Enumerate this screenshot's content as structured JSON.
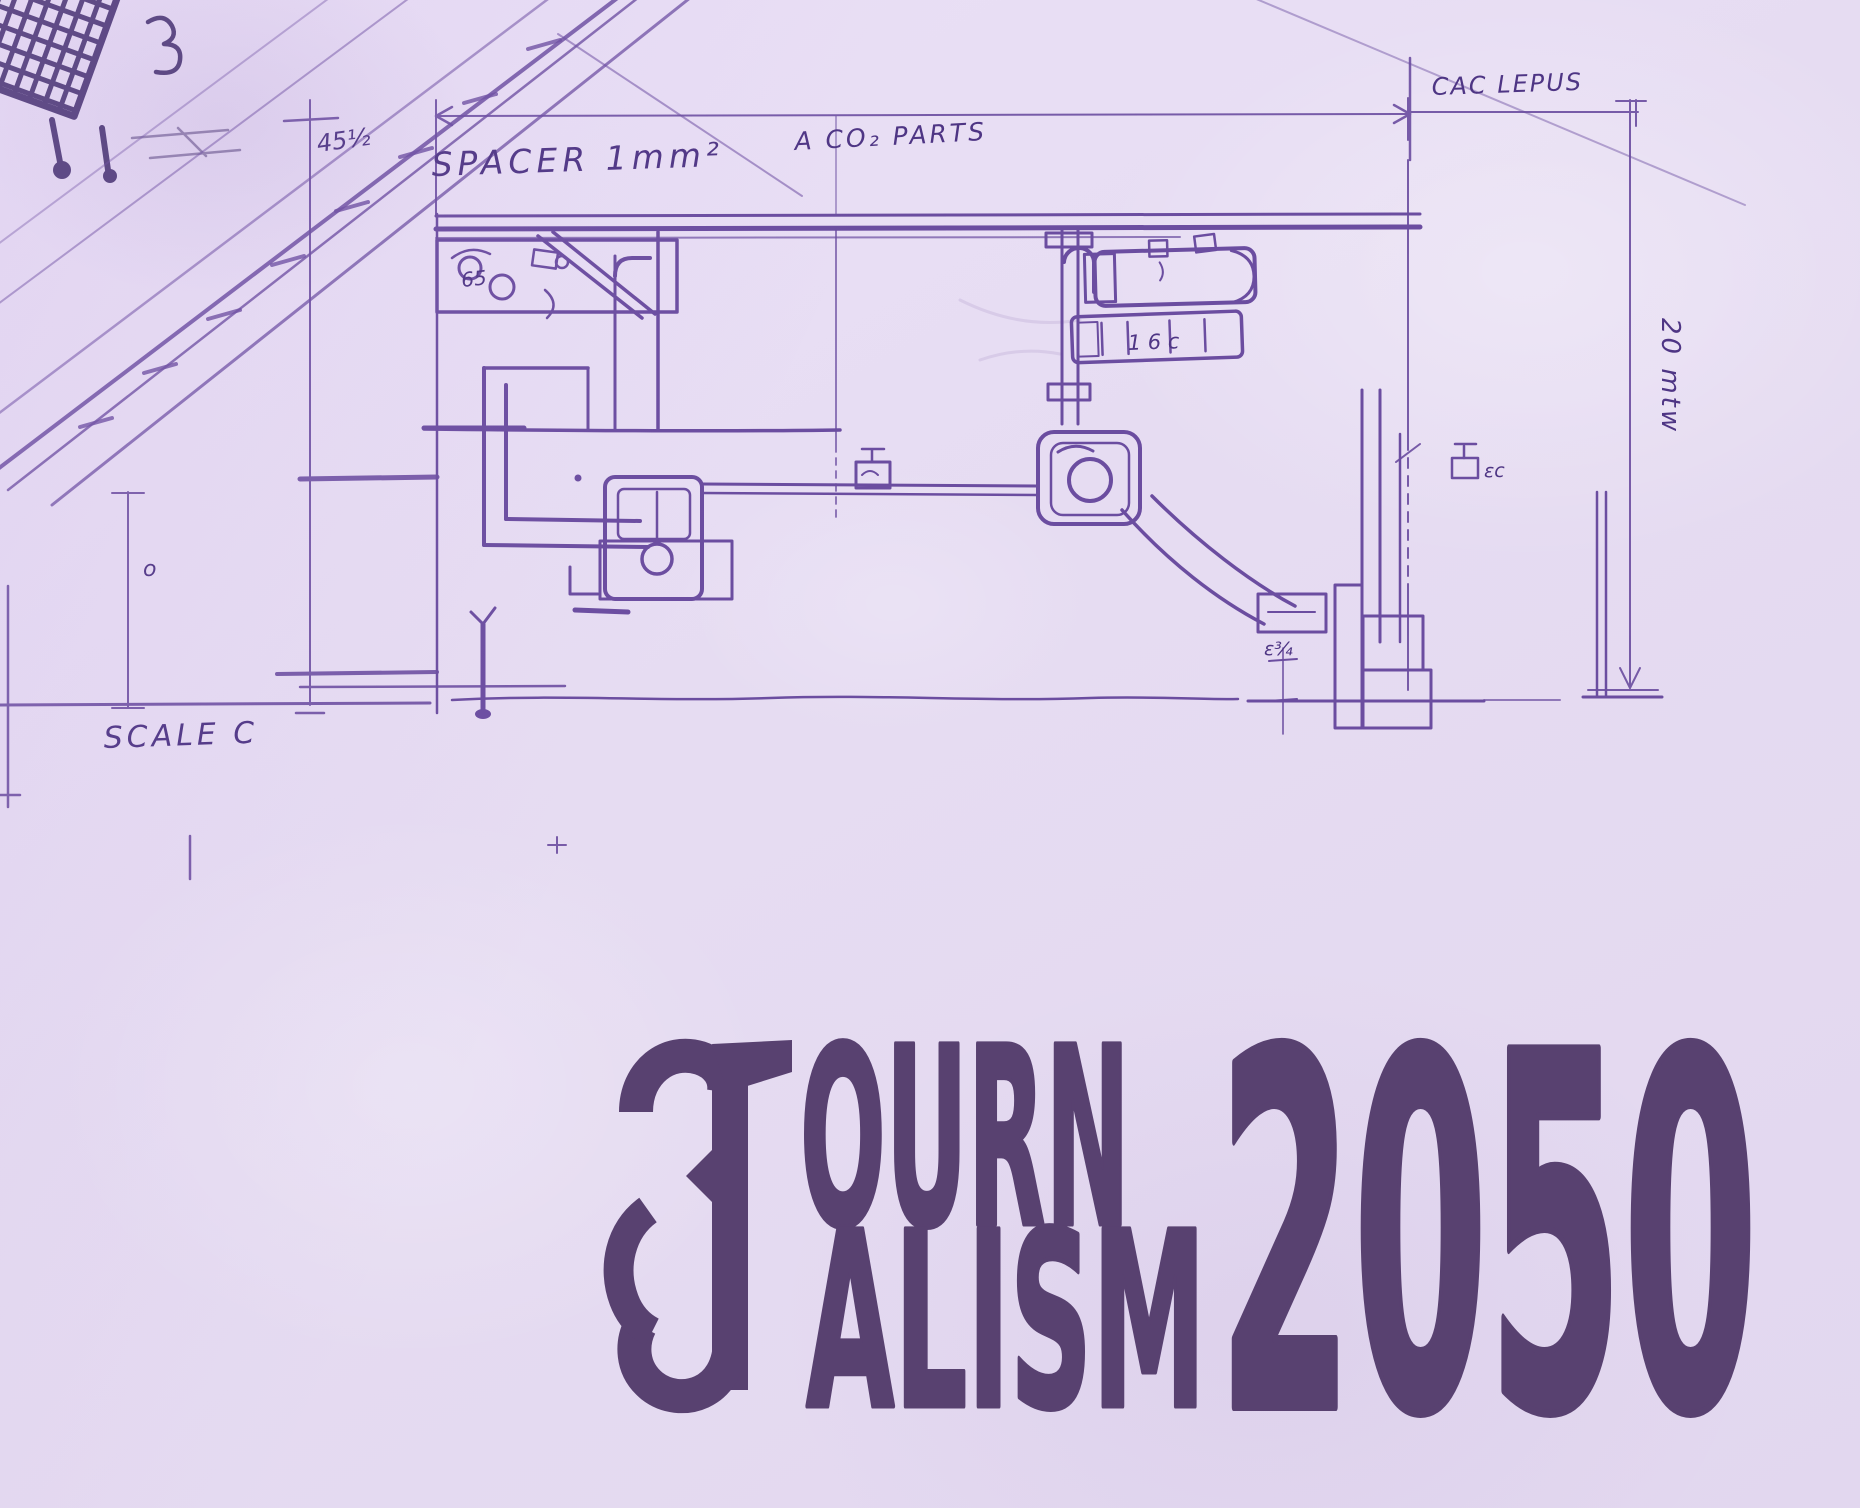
{
  "palette": {
    "paper": "#e6dcf2",
    "ink": "#6b4da0",
    "ink_dark": "#4e3584",
    "building": "#44306e",
    "logo": "#584170"
  },
  "sketch": {
    "annotations": {
      "spacer_label": "SPACER 1mm²",
      "parts_label": "A CO₂ PARTS",
      "top_right_label": "CAC LEPUS",
      "right_dim_label": "20 mtw",
      "left_dim_small": "45½",
      "scale_label": "SCALE C",
      "small_o": "o",
      "housing_mark": "65",
      "cylinder_mark": "1 6 c",
      "fitting_mark": "εc",
      "step_mark": "ε¾"
    }
  },
  "logo": {
    "text": "JOURNALISM 2050",
    "initial": "J",
    "line1": "OURN",
    "line2": "ALISM",
    "year": "2050"
  }
}
